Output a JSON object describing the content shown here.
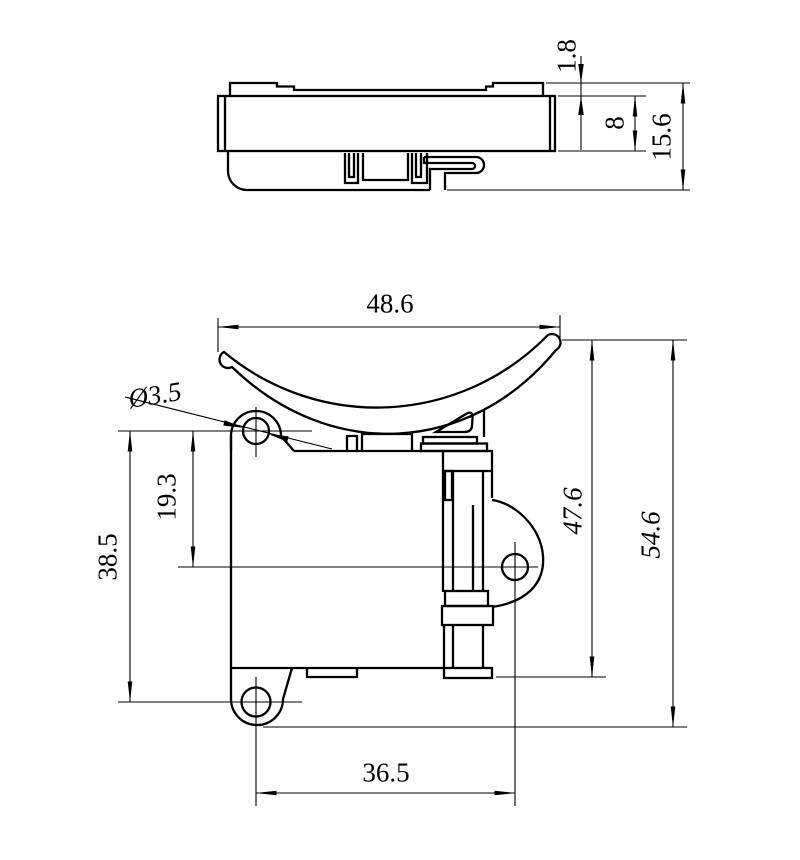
{
  "sheet": {
    "background_color": "#ffffff",
    "line_color": "#000000"
  },
  "side_view": {
    "dims": {
      "plate_thickness": "1.8",
      "body_height": "8",
      "overall_height": "15.6"
    }
  },
  "front_view": {
    "dims": {
      "top_width": "48.6",
      "hole_diameter": "Ø3.5",
      "upper_hole_to_ear_hole": "19.3",
      "upper_to_lower_hole": "38.5",
      "tip_to_rail_bottom": "47.6",
      "overall_height": "54.6",
      "lower_hole_to_ear_hole": "36.5"
    }
  }
}
